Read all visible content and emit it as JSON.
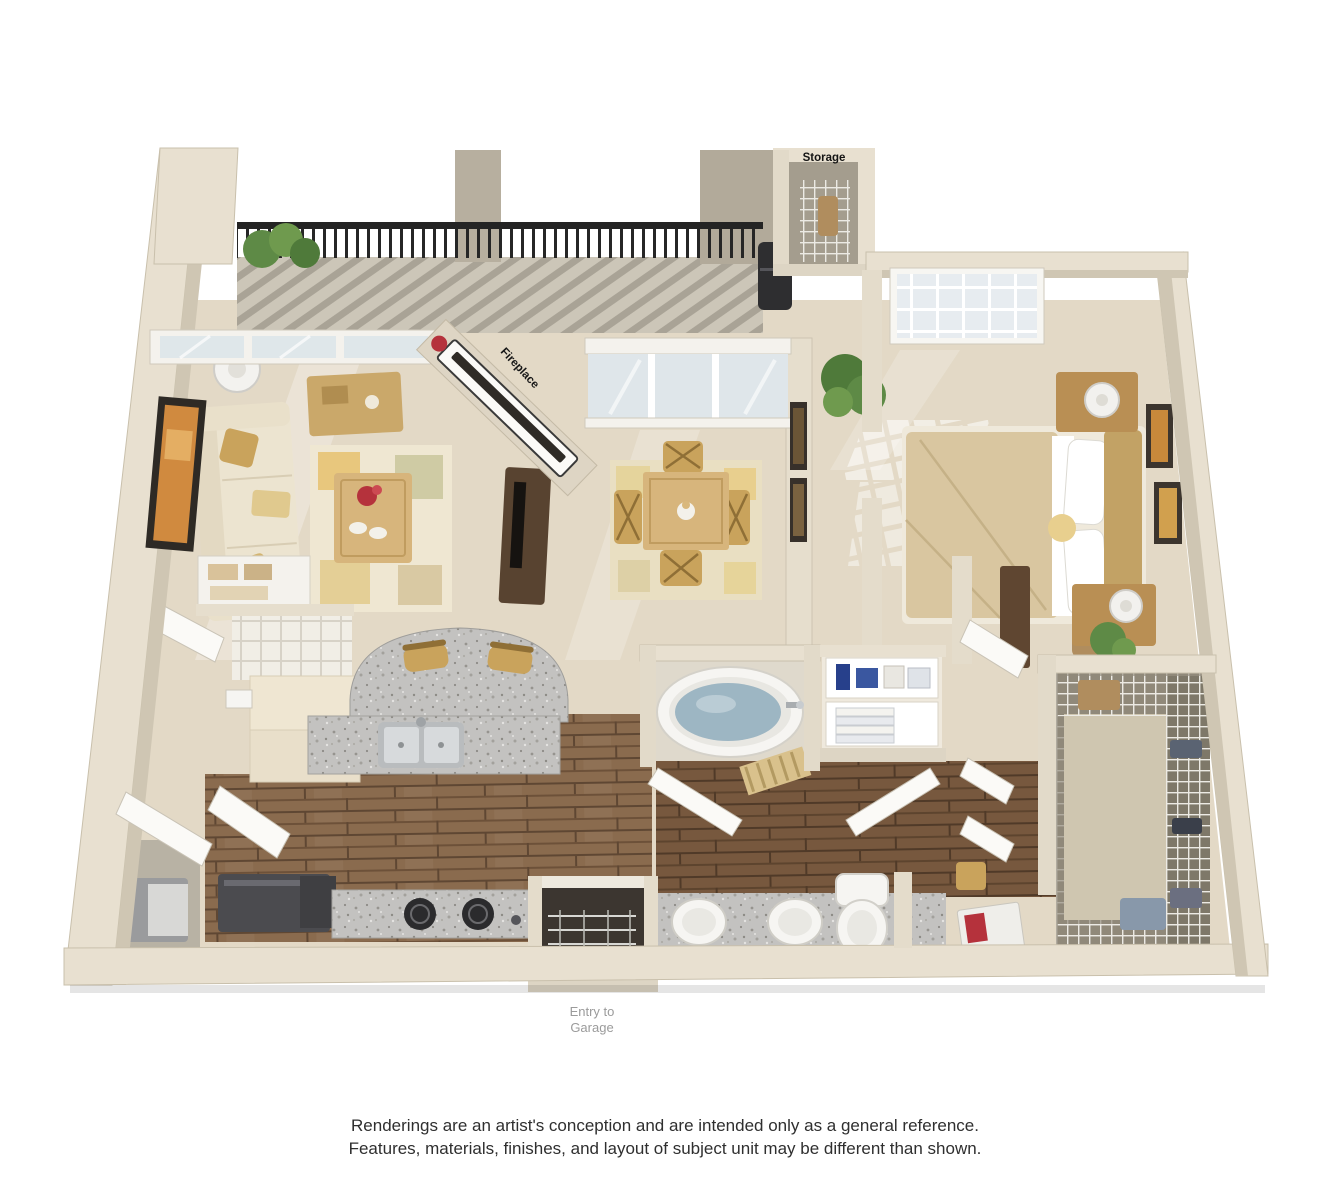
{
  "plan": {
    "labels": {
      "storage": "Storage",
      "fireplace": "Fireplace",
      "entry_line1": "Entry to",
      "entry_line2": "Garage"
    },
    "rooms": [
      "living-room",
      "dining-room",
      "bedroom",
      "kitchen",
      "bathroom",
      "walk-in-closet",
      "storage",
      "balcony",
      "entry"
    ]
  },
  "disclaimer": {
    "line1": "Renderings are an artist's conception and are intended only as a general reference.",
    "line2": "Features, materials, finishes, and layout of subject unit may be different than shown."
  },
  "colors": {
    "wall": "#e8e0d0",
    "wall_shade": "#cdc4b1",
    "carpet": "#e3d9c6",
    "deck": "#ccc6b8",
    "wood_floor": "#8a6b4e",
    "granite": "#c3c2c0",
    "water": "#9db6c3",
    "railing": "#242424",
    "foliage": "#5e8a46",
    "sofa": "#ece4d0",
    "furniture_wood": "#d7b57c",
    "duvet": "#d9c6a0",
    "fixture_white": "#f6f5f2",
    "appliance_dark": "#4b4b4f"
  }
}
